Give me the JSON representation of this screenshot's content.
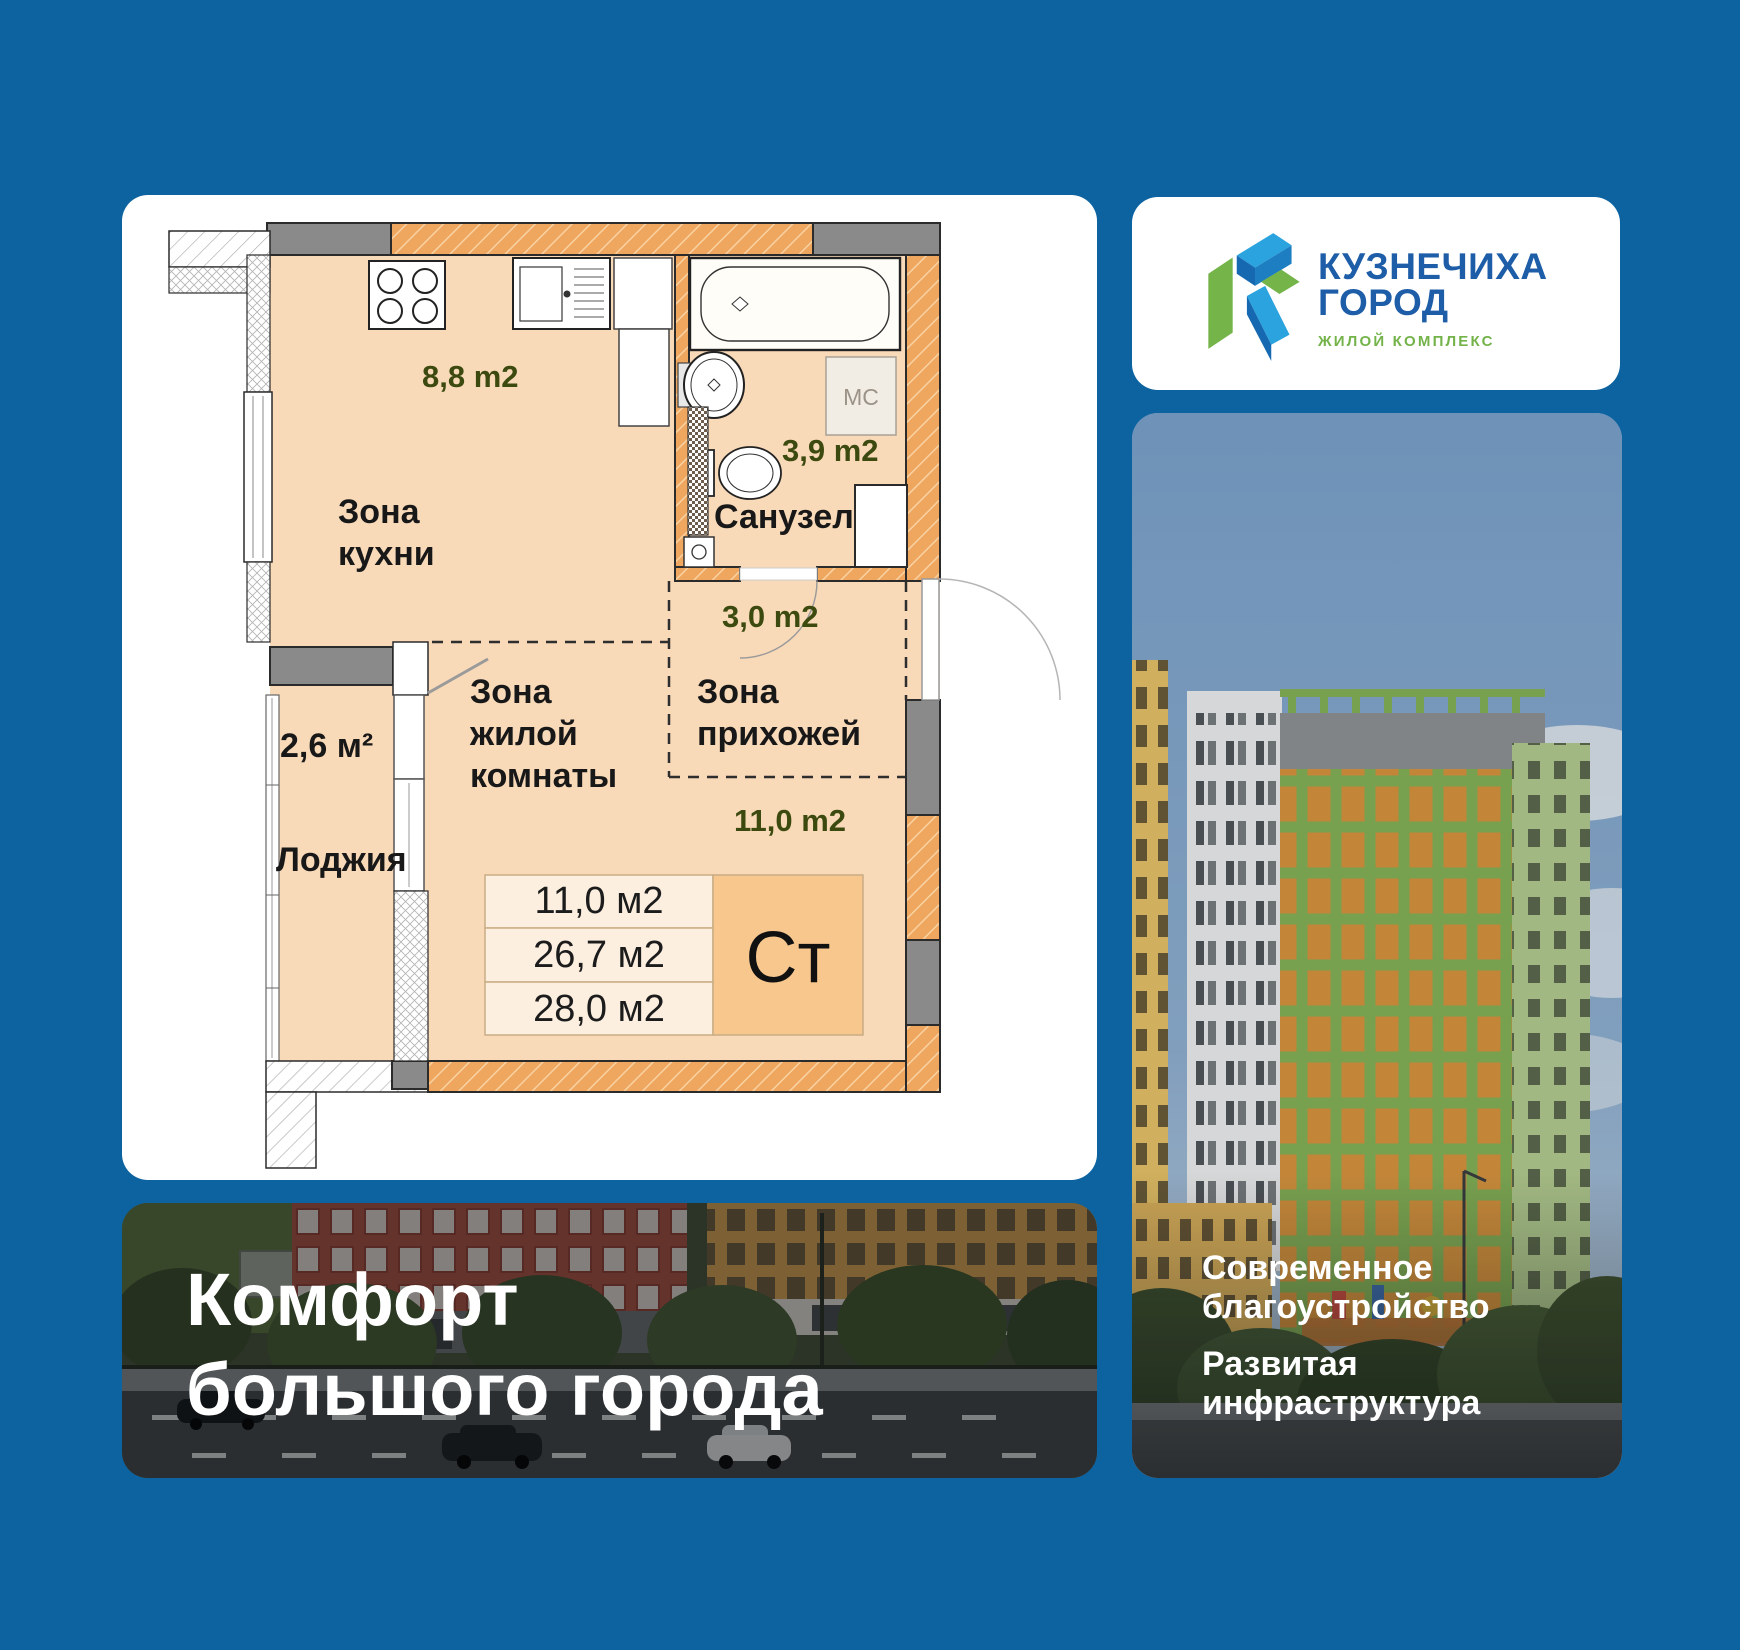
{
  "theme": {
    "background": "#0d63a0",
    "card": "#ffffff",
    "wall_orange": "#efa65e",
    "wall_grey": "#8a8a8a",
    "floor_peach": "#f8d9b8",
    "table_cell": "#fcefdf",
    "type_cell": "#f7c78e",
    "area_label_color": "#3c4a10",
    "logo_blue": "#1e5da7",
    "logo_green": "#73b34a",
    "banner_text": "#ffffff"
  },
  "logo_card": {
    "title_line1": "КУЗНЕЧИХА",
    "title_line2": "ГОРОД",
    "subtitle": "ЖИЛОЙ КОМПЛЕКС"
  },
  "floor_plan": {
    "kitchen_area": "8,8 m2",
    "kitchen_zone_line1": "Зона",
    "kitchen_zone_line2": "кухни",
    "bathroom_area": "3,9 m2",
    "bathroom_name": "Санузел",
    "washer_label": "МС",
    "hallway_area": "3,0 m2",
    "hallway_zone_line1": "Зона",
    "hallway_zone_line2": "прихожей",
    "living_area": "11,0 m2",
    "living_zone_line1": "Зона",
    "living_zone_line2": "жилой",
    "living_zone_line3": "комнаты",
    "loggia_area": "2,6 м²",
    "loggia_name": "Лоджия",
    "table_rows": [
      "11,0 м2",
      "26,7 м2",
      "28,0 м2"
    ],
    "apartment_type": "Ст"
  },
  "left_banner": {
    "line1": "Комфорт",
    "line2": "большого города"
  },
  "right_banner": {
    "block1_line1": "Современное",
    "block1_line2": "благоустройство",
    "block2_line1": "Развитая",
    "block2_line2": "инфраструктура"
  }
}
